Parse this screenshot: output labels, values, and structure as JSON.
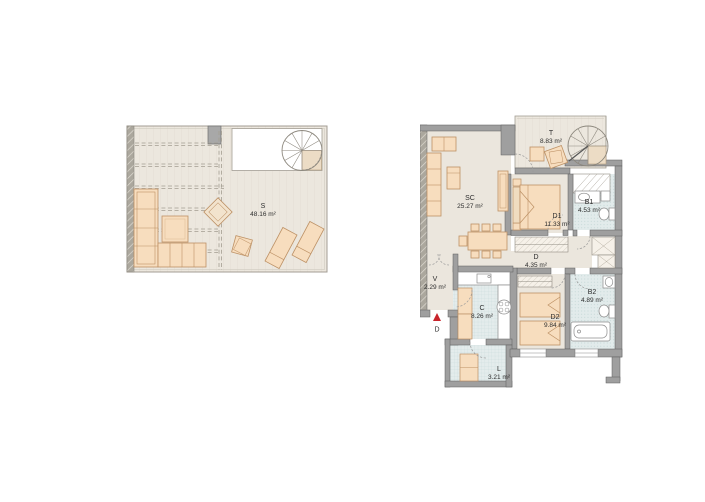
{
  "plans": {
    "terrace": {
      "room": {
        "code": "S",
        "area": "48.16 m²"
      }
    },
    "apartment": {
      "rooms": {
        "sc": {
          "code": "SC",
          "area": "25.27 m²"
        },
        "t": {
          "code": "T",
          "area": "8.83 m²"
        },
        "d1": {
          "code": "D1",
          "area": "11.33 m²"
        },
        "b1": {
          "code": "B1",
          "area": "4.53 m²"
        },
        "d": {
          "code": "D",
          "area": "4.35 m²"
        },
        "b2": {
          "code": "B2",
          "area": "4.89 m²"
        },
        "d2": {
          "code": "D2",
          "area": "9.84 m²"
        },
        "c": {
          "code": "C",
          "area": "8.26 m²"
        },
        "v": {
          "code": "V",
          "area": "2.29 m²"
        },
        "l": {
          "code": "L",
          "area": "3.21 m²"
        }
      },
      "entrance": {
        "label": "D"
      }
    }
  },
  "colors": {
    "wall": "#9f9f9f",
    "floor": "#ebe6dd",
    "furniture": "#f7ddbe",
    "tile": "#e4ecec",
    "bath_tile": "#e2ebeb",
    "entrance_marker": "#c8242b"
  }
}
